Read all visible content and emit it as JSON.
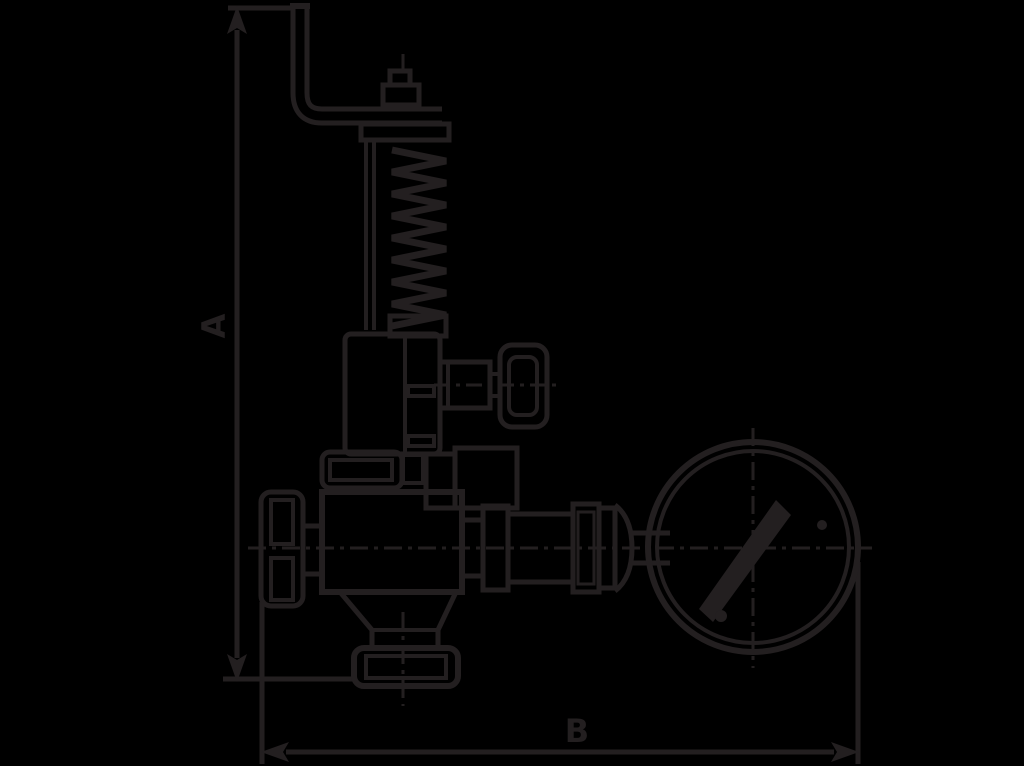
{
  "canvas": {
    "width": 1024,
    "height": 766,
    "background_color": "#000000",
    "line_color": "#231f20"
  },
  "diagram": {
    "type": "technical-line-drawing",
    "subject": "safety-relief-valve-with-pressure-gauge",
    "dim_a_label": "A",
    "dim_b_label": "B",
    "dimensions": [
      {
        "label": "A",
        "orientation": "vertical",
        "measures": "overall height from hand lever top to outlet flange"
      },
      {
        "label": "B",
        "orientation": "horizontal",
        "measures": "overall width from adjusting knob to pressure gauge edge"
      }
    ],
    "parts": [
      "hand-lever",
      "lever-nut",
      "spring-top-plate",
      "spring-coil",
      "spring-stem",
      "bonnet",
      "upper-flange",
      "test-gag-handle",
      "adjusting-knob",
      "valve-body",
      "outlet-neck",
      "outlet-flange",
      "gauge-piping",
      "pressure-gauge",
      "gauge-needle"
    ]
  }
}
